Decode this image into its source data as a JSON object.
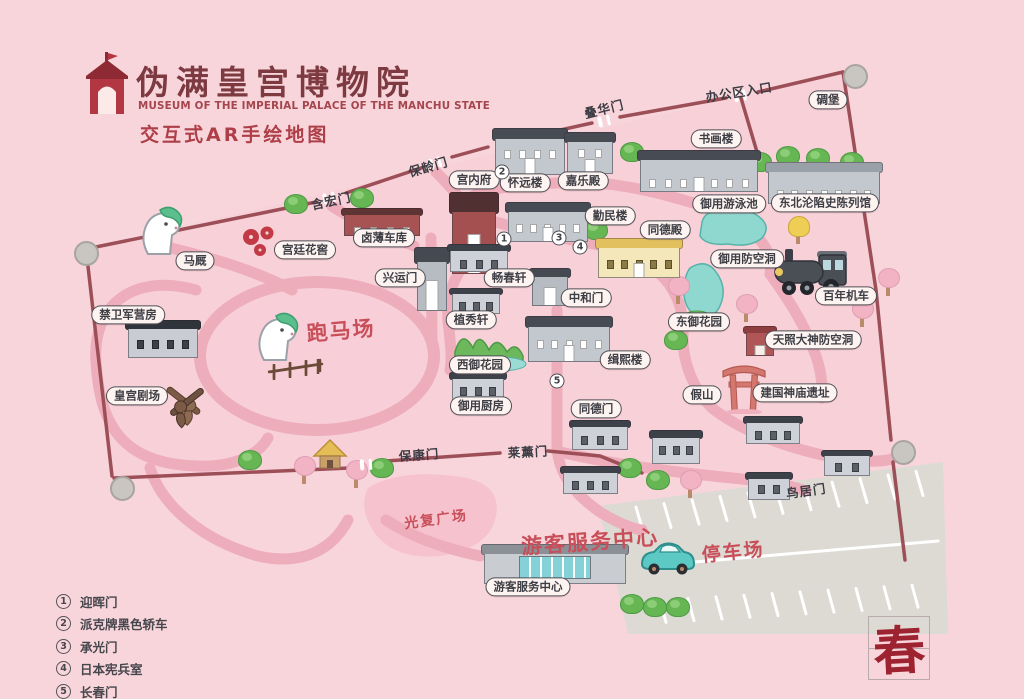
{
  "header": {
    "title_cn": "伪满皇宫博物院",
    "title_en": "MUSEUM OF THE IMPERIAL PALACE OF THE MANCHU STATE",
    "subtitle": "交互式AR手绘地图"
  },
  "colors": {
    "background": "#f8d5db",
    "road": "#edadbb",
    "wall": "#9d4f58",
    "accent_red": "#c84f59",
    "label_text": "#3e3e45",
    "title_red": "#7e3a41",
    "water": "#8fd8cf",
    "parking_grey": "#dddad4"
  },
  "map": {
    "bubbles": [
      {
        "id": "diaobao",
        "text": "碉堡",
        "x": 828,
        "y": 100
      },
      {
        "id": "shuhualou",
        "text": "书画楼",
        "x": 716,
        "y": 139
      },
      {
        "id": "jialedian",
        "text": "嘉乐殿",
        "x": 583,
        "y": 181
      },
      {
        "id": "huaiyuanlou",
        "text": "怀远楼",
        "x": 525,
        "y": 183
      },
      {
        "id": "gongneifu",
        "text": "宫内府",
        "x": 474,
        "y": 180
      },
      {
        "id": "qinminlou",
        "text": "勤民楼",
        "x": 610,
        "y": 216
      },
      {
        "id": "tongdedian",
        "text": "同德殿",
        "x": 665,
        "y": 230
      },
      {
        "id": "yuyongyouyongchi",
        "text": "御用游泳池",
        "x": 729,
        "y": 204
      },
      {
        "id": "chenlieguan",
        "text": "东北沦陷史陈列馆",
        "x": 825,
        "y": 203
      },
      {
        "id": "yuyongfangkongdong",
        "text": "御用防空洞",
        "x": 747,
        "y": 259
      },
      {
        "id": "bainianjiche",
        "text": "百年机车",
        "x": 846,
        "y": 296
      },
      {
        "id": "dongyuhuayuan",
        "text": "东御花园",
        "x": 699,
        "y": 322
      },
      {
        "id": "tianzhaodashen",
        "text": "天照大神防空洞",
        "x": 813,
        "y": 340
      },
      {
        "id": "jiashan",
        "text": "假山",
        "x": 702,
        "y": 395
      },
      {
        "id": "jianguoshenmiao",
        "text": "建国神庙遗址",
        "x": 795,
        "y": 393
      },
      {
        "id": "jixilou",
        "text": "缉熙楼",
        "x": 625,
        "y": 360
      },
      {
        "id": "zhonghemen",
        "text": "中和门",
        "x": 586,
        "y": 298
      },
      {
        "id": "changchunxuan",
        "text": "畅春轩",
        "x": 509,
        "y": 278
      },
      {
        "id": "zhixiuxuan",
        "text": "植秀轩",
        "x": 471,
        "y": 320
      },
      {
        "id": "xiyuhuayuan",
        "text": "西御花园",
        "x": 480,
        "y": 365
      },
      {
        "id": "yuyongchufang",
        "text": "御用厨房",
        "x": 481,
        "y": 406
      },
      {
        "id": "tongdemen",
        "text": "同德门",
        "x": 596,
        "y": 409
      },
      {
        "id": "xingyunmen",
        "text": "兴运门",
        "x": 400,
        "y": 278
      },
      {
        "id": "lubucheku",
        "text": "卤薄车库",
        "x": 384,
        "y": 238
      },
      {
        "id": "gongtinghuajiao",
        "text": "宫廷花窖",
        "x": 305,
        "y": 250
      },
      {
        "id": "majiu",
        "text": "马厩",
        "x": 195,
        "y": 261
      },
      {
        "id": "jinweijun",
        "text": "禁卫军营房",
        "x": 128,
        "y": 315
      },
      {
        "id": "huanggongjuchang",
        "text": "皇宫剧场",
        "x": 137,
        "y": 396
      },
      {
        "id": "fuwuzhongxin",
        "text": "游客服务中心",
        "x": 528,
        "y": 587
      }
    ],
    "plain_labels": [
      {
        "id": "bangongqurukou",
        "text": "办公区入口",
        "x": 739,
        "y": 91,
        "rot": -9
      },
      {
        "id": "diehuamen",
        "text": "叠华门",
        "x": 604,
        "y": 108,
        "rot": -14
      },
      {
        "id": "baolingmen",
        "text": "保龄门",
        "x": 428,
        "y": 166,
        "rot": -16
      },
      {
        "id": "hanhongmen",
        "text": "含宏门",
        "x": 331,
        "y": 200,
        "rot": -12
      },
      {
        "id": "baokangmen",
        "text": "保康门",
        "x": 419,
        "y": 454,
        "rot": -4
      },
      {
        "id": "laixunmen",
        "text": "莱薰门",
        "x": 528,
        "y": 451,
        "rot": -3
      },
      {
        "id": "niaojumen",
        "text": "鸟居门",
        "x": 806,
        "y": 490,
        "rot": -8
      }
    ],
    "red_labels": [
      {
        "id": "paomachang",
        "text": "跑马场",
        "x": 341,
        "y": 330,
        "size": 21,
        "rot": -5
      },
      {
        "id": "guangfuguangchang",
        "text": "光复广场",
        "x": 436,
        "y": 519,
        "size": 14,
        "rot": -8
      },
      {
        "id": "youkefuwuzhongxin",
        "text": "游客服务中心",
        "x": 590,
        "y": 541,
        "size": 21,
        "rot": -4
      },
      {
        "id": "tingchechang",
        "text": "停车场",
        "x": 733,
        "y": 551,
        "size": 19,
        "rot": -6
      }
    ],
    "markers": [
      {
        "num": "2",
        "x": 502,
        "y": 172
      },
      {
        "num": "1",
        "x": 504,
        "y": 239
      },
      {
        "num": "3",
        "x": 559,
        "y": 238
      },
      {
        "num": "4",
        "x": 580,
        "y": 247
      },
      {
        "num": "5",
        "x": 557,
        "y": 381
      }
    ],
    "legend": {
      "items": [
        {
          "num": "1",
          "label": "迎晖门"
        },
        {
          "num": "2",
          "label": "派克牌黑色轿车"
        },
        {
          "num": "3",
          "label": "承光门"
        },
        {
          "num": "4",
          "label": "日本宪兵室"
        },
        {
          "num": "5",
          "label": "长春门"
        }
      ]
    },
    "seal": "春",
    "buildings": [
      {
        "id": "huaiyuan",
        "type": "grey",
        "x": 495,
        "y": 128,
        "w": 70,
        "h": 47
      },
      {
        "id": "jiale",
        "type": "grey",
        "x": 567,
        "y": 132,
        "w": 46,
        "h": 42
      },
      {
        "id": "shuhua",
        "type": "grey",
        "x": 640,
        "y": 150,
        "w": 118,
        "h": 42
      },
      {
        "id": "chenlie",
        "type": "greyflat",
        "x": 768,
        "y": 162,
        "w": 112,
        "h": 42
      },
      {
        "id": "gongneifu",
        "type": "redgate",
        "x": 452,
        "y": 192,
        "w": 44,
        "h": 82
      },
      {
        "id": "qinmin",
        "type": "grey",
        "x": 508,
        "y": 202,
        "w": 80,
        "h": 40
      },
      {
        "id": "tongde-hall",
        "type": "yellow",
        "x": 598,
        "y": 238,
        "w": 82,
        "h": 40
      },
      {
        "id": "lubu-garage",
        "type": "red",
        "x": 344,
        "y": 208,
        "w": 76,
        "h": 28
      },
      {
        "id": "xingyun-gate",
        "type": "gate",
        "x": 417,
        "y": 247,
        "w": 30,
        "h": 64
      },
      {
        "id": "changchun-xuan",
        "type": "trad",
        "x": 450,
        "y": 244,
        "w": 58,
        "h": 28
      },
      {
        "id": "zhixiu-xuan",
        "type": "trad",
        "x": 452,
        "y": 288,
        "w": 48,
        "h": 26
      },
      {
        "id": "zhonghe-gate",
        "type": "gate",
        "x": 532,
        "y": 268,
        "w": 36,
        "h": 38
      },
      {
        "id": "jixi",
        "type": "grey",
        "x": 528,
        "y": 316,
        "w": 82,
        "h": 46
      },
      {
        "id": "kitchen",
        "type": "trad",
        "x": 452,
        "y": 372,
        "w": 52,
        "h": 28
      },
      {
        "id": "tongde-gate",
        "type": "trad",
        "x": 572,
        "y": 420,
        "w": 56,
        "h": 30
      },
      {
        "id": "house-a",
        "type": "trad",
        "x": 563,
        "y": 466,
        "w": 55,
        "h": 28
      },
      {
        "id": "house-b",
        "type": "trad",
        "x": 652,
        "y": 430,
        "w": 48,
        "h": 34
      },
      {
        "id": "shrine-house",
        "type": "trad",
        "x": 746,
        "y": 416,
        "w": 54,
        "h": 28
      },
      {
        "id": "house-c",
        "type": "trad",
        "x": 824,
        "y": 450,
        "w": 46,
        "h": 26
      },
      {
        "id": "house-d",
        "type": "trad",
        "x": 748,
        "y": 472,
        "w": 42,
        "h": 28
      },
      {
        "id": "barracks",
        "type": "dark",
        "x": 128,
        "y": 320,
        "w": 70,
        "h": 38
      },
      {
        "id": "visitor-center",
        "type": "visitor",
        "x": 484,
        "y": 544,
        "w": 142,
        "h": 40
      },
      {
        "id": "amaterasu-shed",
        "type": "redshed",
        "x": 746,
        "y": 326,
        "w": 28,
        "h": 30
      }
    ],
    "decorations": [
      {
        "id": "white-horse-stable",
        "type": "horse",
        "x": 136,
        "y": 206
      },
      {
        "id": "white-horse-track",
        "type": "horse",
        "x": 252,
        "y": 312
      },
      {
        "id": "locomotive",
        "type": "loco",
        "x": 773,
        "y": 245
      },
      {
        "id": "teal-car",
        "type": "car",
        "x": 638,
        "y": 540
      },
      {
        "id": "torii",
        "type": "torii",
        "x": 722,
        "y": 360
      },
      {
        "id": "crossed-pistols",
        "type": "pistols",
        "x": 160,
        "y": 382
      },
      {
        "id": "yellow-hut",
        "type": "hut",
        "x": 312,
        "y": 438
      },
      {
        "id": "track-fence",
        "type": "fence",
        "x": 266,
        "y": 356
      },
      {
        "id": "plum-flowers",
        "type": "flowers",
        "x": 238,
        "y": 224
      }
    ],
    "bushes": [
      [
        284,
        194
      ],
      [
        350,
        188
      ],
      [
        620,
        142
      ],
      [
        748,
        152
      ],
      [
        776,
        146
      ],
      [
        806,
        148
      ],
      [
        840,
        152
      ],
      [
        584,
        220
      ],
      [
        618,
        458
      ],
      [
        646,
        470
      ],
      [
        370,
        458
      ],
      [
        238,
        450
      ],
      [
        664,
        330
      ],
      [
        620,
        594
      ],
      [
        643,
        597
      ],
      [
        666,
        597
      ]
    ],
    "cherries": [
      [
        294,
        456
      ],
      [
        346,
        460
      ],
      [
        736,
        294
      ],
      [
        852,
        299
      ],
      [
        878,
        268
      ],
      [
        680,
        470
      ],
      [
        668,
        276
      ]
    ],
    "yellow_trees": [
      [
        788,
        216
      ]
    ],
    "bunkers": [
      [
        843,
        64
      ],
      [
        74,
        241
      ],
      [
        110,
        476
      ],
      [
        891,
        440
      ]
    ]
  }
}
